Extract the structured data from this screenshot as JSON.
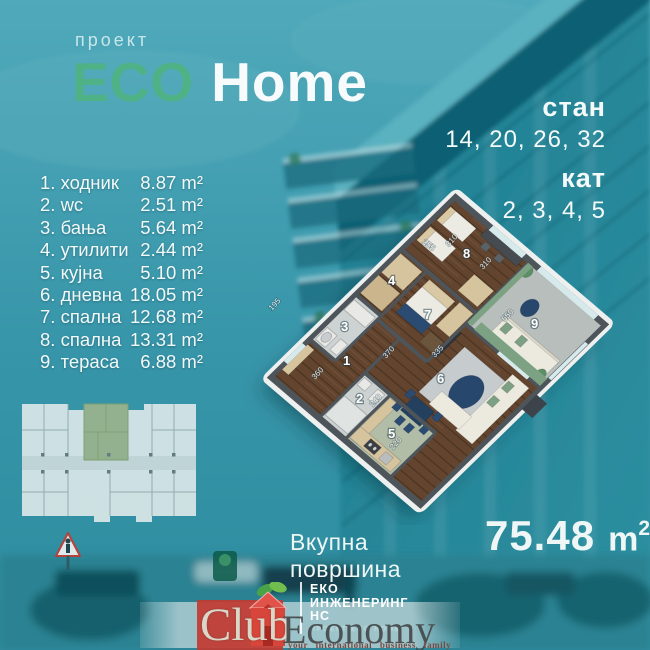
{
  "header": {
    "project_label": "проект",
    "title_eco": "ECO",
    "title_home": "Home"
  },
  "unit_info": {
    "stan_label": "стан",
    "stan_values": "14, 20, 26, 32",
    "kat_label": "кат",
    "kat_values": "2, 3, 4, 5"
  },
  "rooms": [
    {
      "label": "1. ходник",
      "area": "8.87 m²"
    },
    {
      "label": "2. wc",
      "area": "2.51 m²"
    },
    {
      "label": "3. бања",
      "area": "5.64 m²"
    },
    {
      "label": "4. утилити",
      "area": "2.44 m²"
    },
    {
      "label": "5. кујна",
      "area": "5.10 m²"
    },
    {
      "label": "6. дневна",
      "area": "18.05 m²"
    },
    {
      "label": "7. спална",
      "area": "12.68 m²"
    },
    {
      "label": "8. спална",
      "area": "13.31 m²"
    },
    {
      "label": "9. тераса",
      "area": "6.88 m²"
    }
  ],
  "floor_plan": {
    "numbers": [
      "1",
      "2",
      "3",
      "4",
      "5",
      "6",
      "7",
      "8",
      "9"
    ],
    "dims": [
      "255",
      "310",
      "310",
      "550",
      "195",
      "360",
      "370",
      "335",
      "240",
      "220"
    ]
  },
  "total": {
    "label": "Вкупна површина",
    "value": "75.48",
    "unit_base": "m",
    "unit_sup": "2"
  },
  "developer": {
    "line1": "ЕКО",
    "line2": "ИНЖЕНЕРИНГ",
    "line3": "НС",
    "subtext": "ПРОЕКТ ECO HOME"
  },
  "watermark": {
    "club": "Club",
    "economy": "Economy",
    "tagline": "your international business family"
  },
  "colors": {
    "eco_green": "#4fb286",
    "teal_sky": "#4fa9ba",
    "teal_deep": "#0e6173",
    "logo_red": "#c23a31",
    "plan_wood": "#63452f",
    "curtain_green": "#7da283"
  }
}
